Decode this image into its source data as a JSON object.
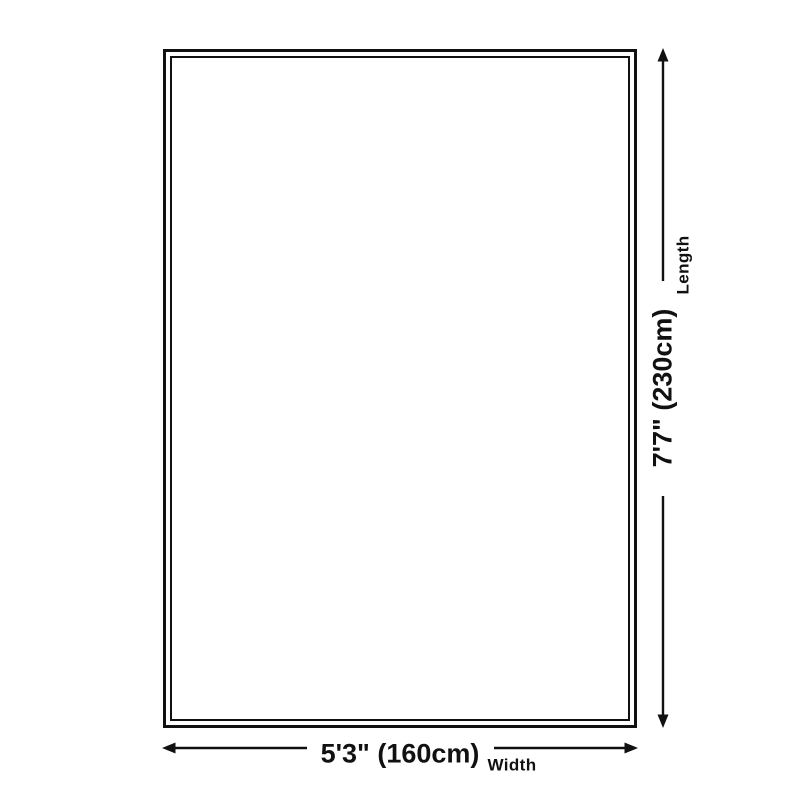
{
  "colors": {
    "ink": "#111111",
    "background": "#ffffff"
  },
  "dimensions": {
    "length": {
      "label": "Length",
      "value": "7'7\" (230cm)"
    },
    "width": {
      "label": "Width",
      "value": "5'3\" (160cm)"
    }
  },
  "icons": {
    "length_arrow": "double-headed-vertical-arrow",
    "width_arrow": "double-headed-horizontal-arrow"
  }
}
